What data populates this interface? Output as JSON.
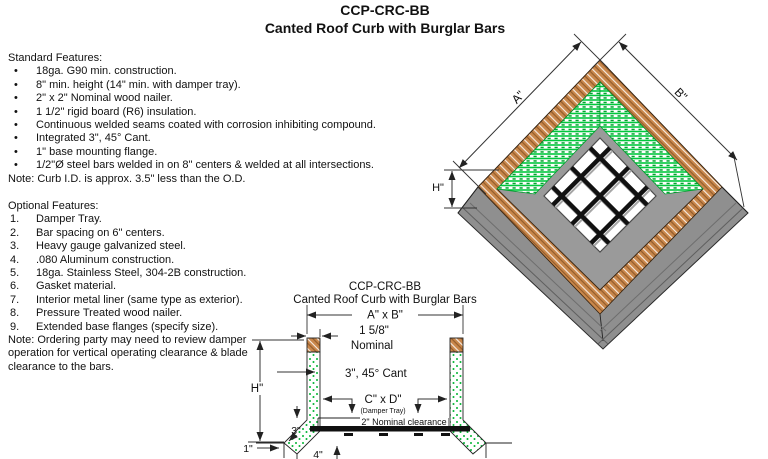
{
  "title": {
    "line1": "CCP-CRC-BB",
    "line2": "Canted Roof Curb with Burglar Bars"
  },
  "standard_features": {
    "heading": "Standard Features:",
    "bullet": "•",
    "items": [
      "18ga. G90 min. construction.",
      "8\" min. height (14\" min. with damper tray).",
      "2\" x 2\" Nominal wood nailer.",
      "1 1/2\" rigid board (R6) insulation.",
      "Continuous welded seams coated with corrosion inhibiting compound.",
      "Integrated 3\", 45° Cant.",
      "1\" base mounting flange.",
      "1/2\"Ø steel bars welded in on 8\" centers & welded at all intersections."
    ],
    "note": "Note: Curb I.D. is approx. 3.5\" less than the O.D."
  },
  "optional_features": {
    "heading": "Optional Features:",
    "items": [
      {
        "n": "1.",
        "t": "Damper Tray."
      },
      {
        "n": "2.",
        "t": "Bar spacing on 6\" centers."
      },
      {
        "n": "3.",
        "t": "Heavy gauge galvanized steel."
      },
      {
        "n": "4.",
        "t": ".080 Aluminum construction."
      },
      {
        "n": "5.",
        "t": "18ga. Stainless Steel, 304-2B construction."
      },
      {
        "n": "6.",
        "t": "Gasket material."
      },
      {
        "n": "7.",
        "t": "Interior metal liner (same type as exterior)."
      },
      {
        "n": "8.",
        "t": "Pressure Treated wood nailer."
      },
      {
        "n": "9.",
        "t": "Extended base flanges (specify size)."
      }
    ],
    "note_lines": [
      "Note: Ordering party may need to review damper",
      "operation for vertical operating clearance & blade",
      "clearance to the bars."
    ]
  },
  "iso": {
    "label_a": "A\"",
    "label_b": "B\"",
    "label_h": "H\""
  },
  "section": {
    "title1": "CCP-CRC-BB",
    "title2": "Canted Roof Curb with Burglar Bars",
    "dim_axb": "A\" x B\"",
    "nailer_dim1": "1 5/8\"",
    "nailer_dim2": "Nominal",
    "cant_label": "3\", 45° Cant",
    "dim_cxd": "C\" x D\"",
    "damper_tray": "(Damper Tray)",
    "clearance": "2\" Nominal clearance",
    "dim_h": "H\"",
    "dim_3": "3\"",
    "dim_1": "1\"",
    "dim_4": "4\""
  },
  "colors": {
    "wood": "#C9874B",
    "insulation_green": "#00C83C",
    "metal_gray": "#8F8F8F",
    "bars": "#111111"
  }
}
